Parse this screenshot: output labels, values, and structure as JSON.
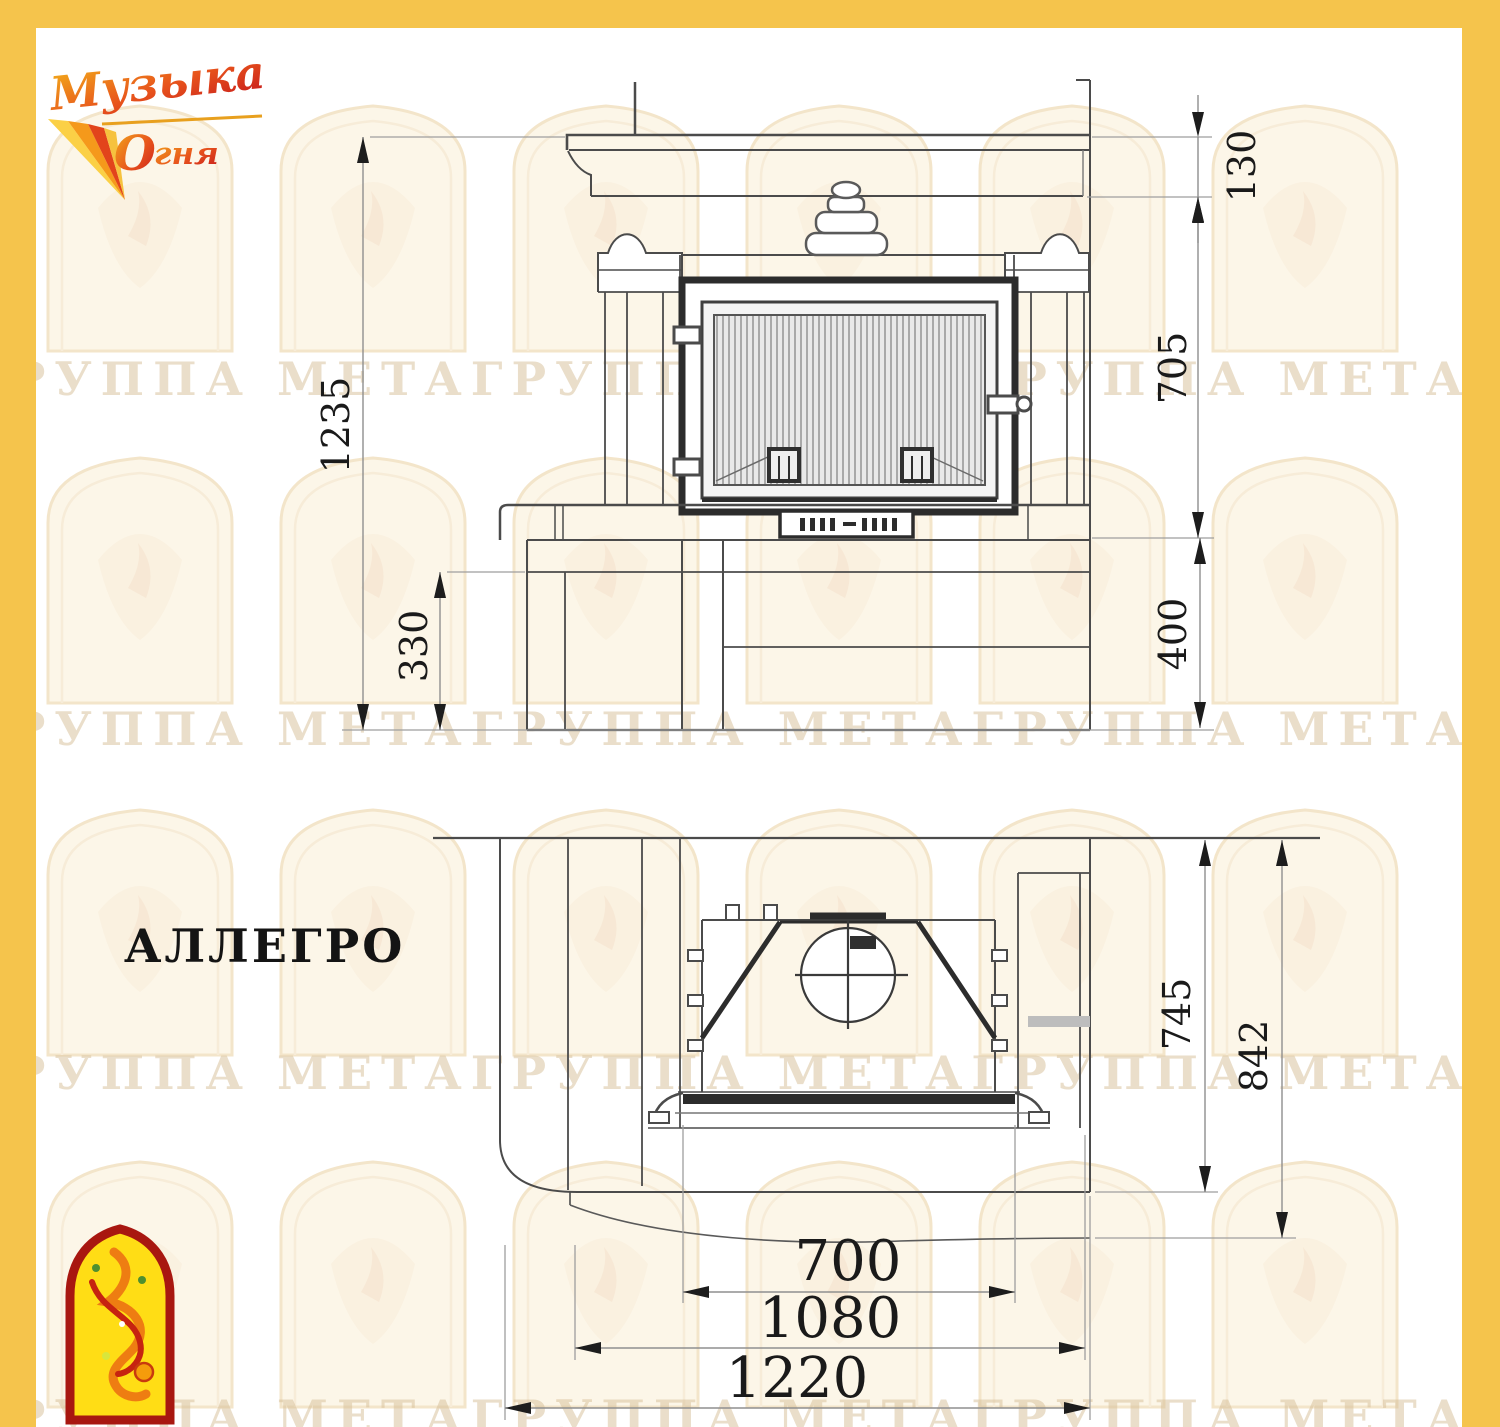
{
  "sheet": {
    "model_name": "АЛЛЕГРО"
  },
  "brand": {
    "logo_top": {
      "line1": "Музыка",
      "line2_initial": "О",
      "line2_rest": "гня"
    },
    "colors": {
      "frame_yellow": "#F5C44C",
      "logo_red": "#C4161C",
      "logo_orange": "#EE7D12",
      "logo_gold": "#F7B819",
      "emblem_yellow": "#FFDD15",
      "emblem_border_red": "#A81710"
    }
  },
  "watermark": {
    "row_text": "ГРУППА МЕТАГРУППА МЕТАГРУППА МЕТАГРУППА МЕТАГРУППА МЕТА"
  },
  "front_view": {
    "dims": {
      "total_height": "1235",
      "mantel_band": "130",
      "portal_height": "705",
      "bench_height": "330",
      "plinth_height": "400"
    }
  },
  "plan_view": {
    "dims": {
      "depth_to_front": "745",
      "depth_total": "842",
      "firebox_width": "700",
      "front_width": "1080",
      "total_width": "1220"
    }
  }
}
